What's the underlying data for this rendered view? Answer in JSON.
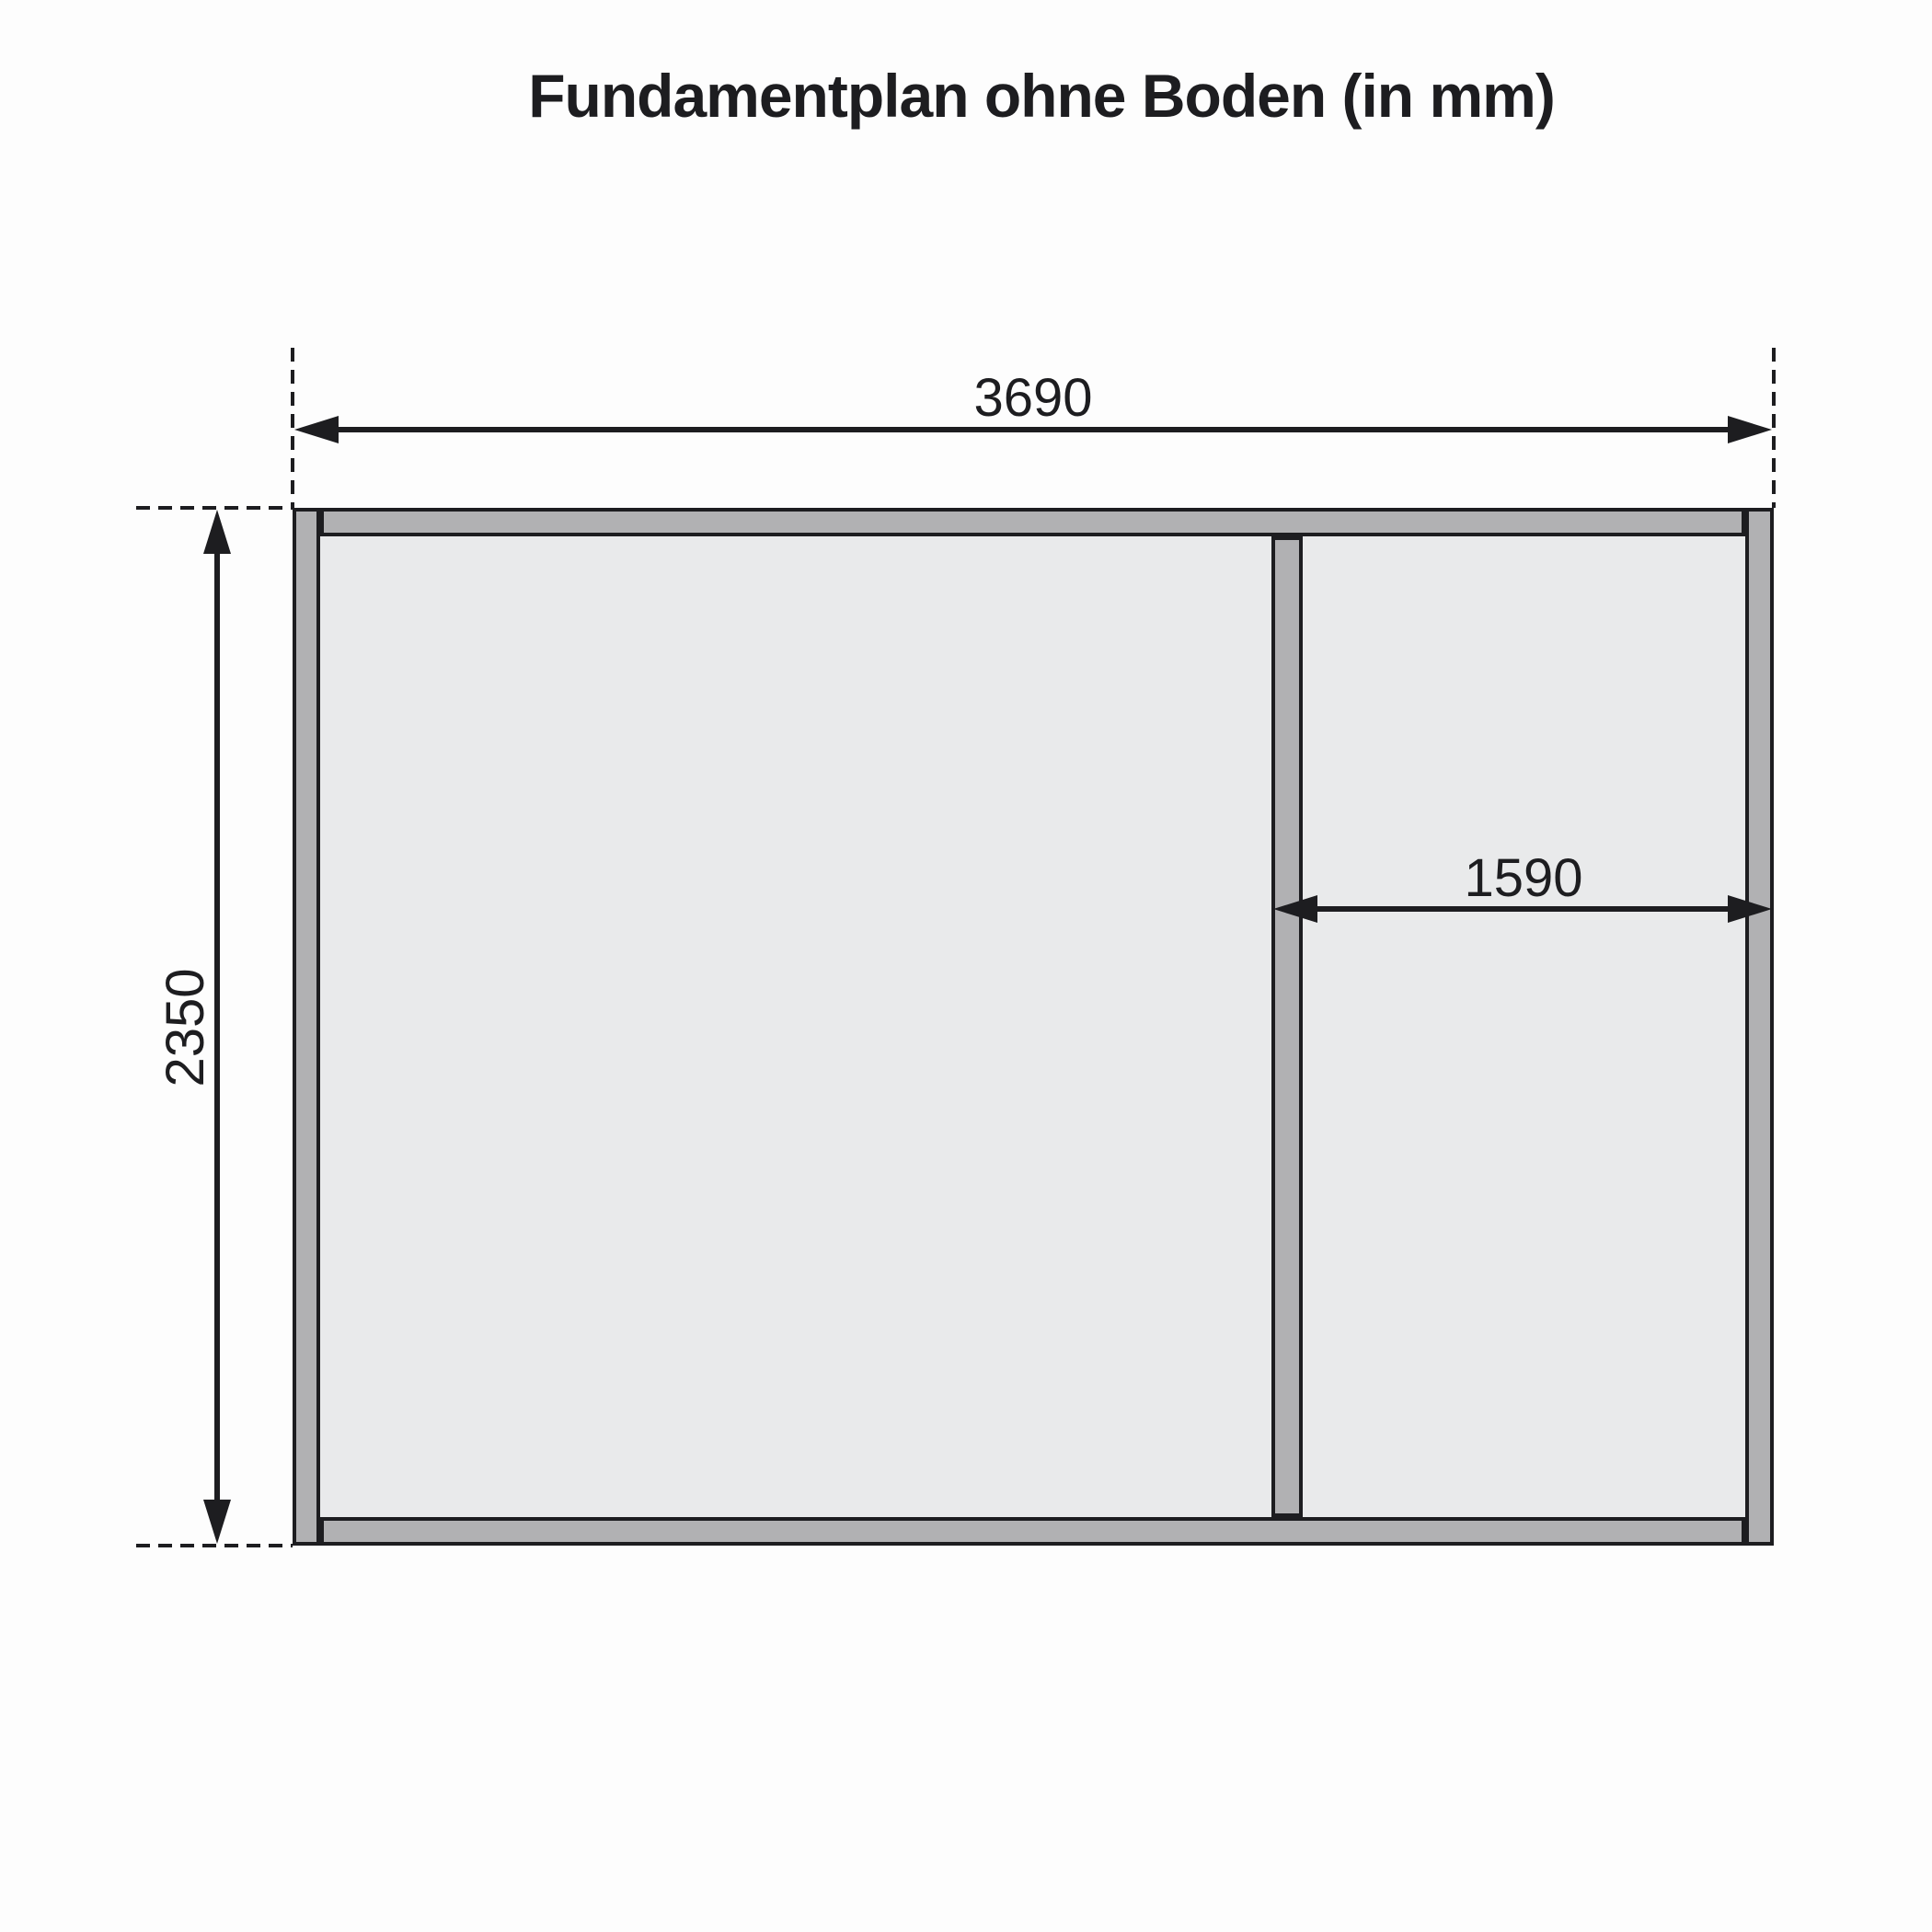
{
  "title": "Fundamentplan ohne Boden (in mm)",
  "diagram": {
    "type": "foundation-plan",
    "unit": "mm",
    "dimensions": {
      "outer_width": "3690",
      "outer_height": "2350",
      "right_bay_width": "1590"
    },
    "colors": {
      "beam": "#b1b1b3",
      "interior": "#e9eaeb",
      "line": "#1d1d20",
      "background": "#fdfdfd"
    }
  }
}
